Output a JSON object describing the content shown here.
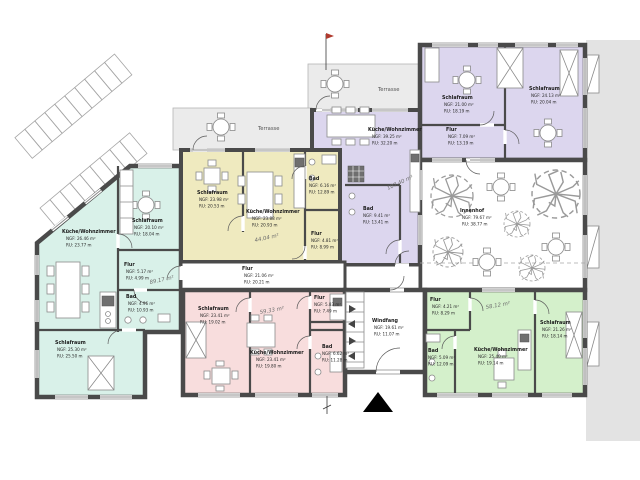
{
  "plan": {
    "colors": {
      "mint": "#d9f1e9",
      "yellow": "#efeabf",
      "lavender": "#dcd6ee",
      "pink": "#f8dddd",
      "green": "#d4f0cb",
      "terrace": "#ebebeb",
      "exterior": "#e3e3e3",
      "wall": "#4a4a4a"
    },
    "terrace_upper_label": "Terrasse",
    "terrace_lower_label": "Terrasse",
    "innenhof": {
      "name": "Innenhof",
      "ngf": "NGF: 79.67 m²",
      "ru": "RU:  38.77 m"
    },
    "windfang": {
      "name": "Windfang",
      "ngf": "NGF: 19.61 m²",
      "ru": "RU:  11.07 m"
    },
    "central_flur": {
      "name": "Flur",
      "ngf": "NGF: 21.06 m²",
      "ru": "RU:  20.21 m"
    },
    "units": {
      "mint": {
        "total": "89.17 m²",
        "kueche": {
          "name": "Küche/Wohnzimmer",
          "ngf": "NGF: 26.46 m²",
          "ru": "RU:  23.77 m"
        },
        "schlafraum_oben": {
          "name": "Schlafraum",
          "ngf": "NGF: 20.10 m²",
          "ru": "RU:  18.04 m"
        },
        "flur": {
          "name": "Flur",
          "ngf": "NGF: 5.17 m²",
          "ru": "RU:  4.99 m"
        },
        "bad": {
          "name": "Bad",
          "ngf": "NGF: 4.96 m²",
          "ru": "RU:  10.93 m"
        },
        "schlafraum_unten": {
          "name": "Schlafraum",
          "ngf": "NGF: 25.30 m²",
          "ru": "RU:  25.50 m"
        }
      },
      "yellow": {
        "total": "44.04 m²",
        "schlafraum": {
          "name": "Schlafraum",
          "ngf": "NGF: 23.98 m²",
          "ru": "RU:  20.53 m"
        },
        "kueche": {
          "name": "Küche/Wohnzimmer",
          "ngf": "NGF: 23.88 m²",
          "ru": "RU:  20.93 m"
        },
        "bad": {
          "name": "Bad",
          "ngf": "NGF: 6.16 m²",
          "ru": "RU:  12.89 m"
        },
        "flur": {
          "name": "Flur",
          "ngf": "NGF: 4.81 m²",
          "ru": "RU:  8.99 m"
        }
      },
      "lavender": {
        "total": "107.40 m²",
        "kueche": {
          "name": "Küche/Wohnzimmer",
          "ngf": "NGF: 39.25 m²",
          "ru": "RU:  32.20 m"
        },
        "bad": {
          "name": "Bad",
          "ngf": "NGF: 9.41 m²",
          "ru": "RU:  13.41 m"
        },
        "schlafraum_links": {
          "name": "Schlafraum",
          "ngf": "NGF: 21.00 m²",
          "ru": "RU:  18.19 m"
        },
        "flur": {
          "name": "Flur",
          "ngf": "NGF: 7.09 m²",
          "ru": "RU:  13.19 m"
        },
        "schlafraum_rechts": {
          "name": "Schlafraum",
          "ngf": "NGF: 24.13 m²",
          "ru": "RU:  20.04 m"
        }
      },
      "pink": {
        "total": "59.33 m²",
        "schlafraum": {
          "name": "Schlafraum",
          "ngf": "NGF: 23.41 m²",
          "ru": "RU:  19.02 m"
        },
        "kueche": {
          "name": "Küche/Wohnzimmer",
          "ngf": "NGF: 23.41 m²",
          "ru": "RU:  19.80 m"
        },
        "flur": {
          "name": "Flur",
          "ngf": "NGF: 5.83 m²",
          "ru": "RU:  7.49 m"
        },
        "bad": {
          "name": "Bad",
          "ngf": "NGF: 6.62 m²",
          "ru": "RU:  11.28 m"
        }
      },
      "green": {
        "total": "58.12 m²",
        "flur": {
          "name": "Flur",
          "ngf": "NGF: 4.21 m²",
          "ru": "RU:  8.29 m"
        },
        "bad": {
          "name": "Bad",
          "ngf": "NGF: 5.09 m²",
          "ru": "RU:  12.09 m"
        },
        "kueche": {
          "name": "Küche/Wohnzimmer",
          "ngf": "NGF: 25.40 m²",
          "ru": "RU:  19.14 m"
        },
        "schlafraum": {
          "name": "Schlafraum",
          "ngf": "NGF: 21.26 m²",
          "ru": "RU:  18.14 m"
        }
      }
    }
  }
}
